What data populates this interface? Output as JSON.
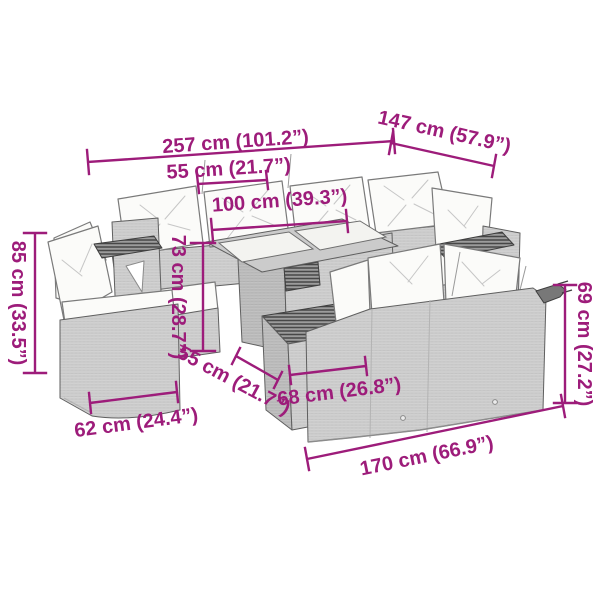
{
  "colors": {
    "accent": "#9d1c7a",
    "background": "#ffffff",
    "furniture_wicker": "#d8d8d8",
    "cushion": "#fbfbf9",
    "outline": "#5f5f5f"
  },
  "product": {
    "type": "garden-lounge-furniture-set-dimension-diagram",
    "pieces": [
      "back-sofa-with-corner",
      "left-chair",
      "coffee-table-with-glass-top",
      "footstool",
      "two-seater-sofa"
    ]
  },
  "dimensions": {
    "overall_width": {
      "label": "257 cm (101.2”)"
    },
    "overall_depth": {
      "label": "147 cm (57.9”)"
    },
    "seat_width_top": {
      "label": "55 cm (21.7”)"
    },
    "table_width": {
      "label": "100 cm (39.3”)"
    },
    "table_height": {
      "label": "73 cm (28.7”)"
    },
    "backrest_height_left": {
      "label": "85 cm (33.5”)"
    },
    "seat_depth": {
      "label": "55 cm (21.7”)"
    },
    "footstool_width": {
      "label": "68 cm (26.8”)"
    },
    "chair_width": {
      "label": "62 cm (24.4”)"
    },
    "sofa_height_right": {
      "label": "69 cm (27.2”)"
    },
    "sofa_width_bottom": {
      "label": "170 cm (66.9”)"
    }
  }
}
